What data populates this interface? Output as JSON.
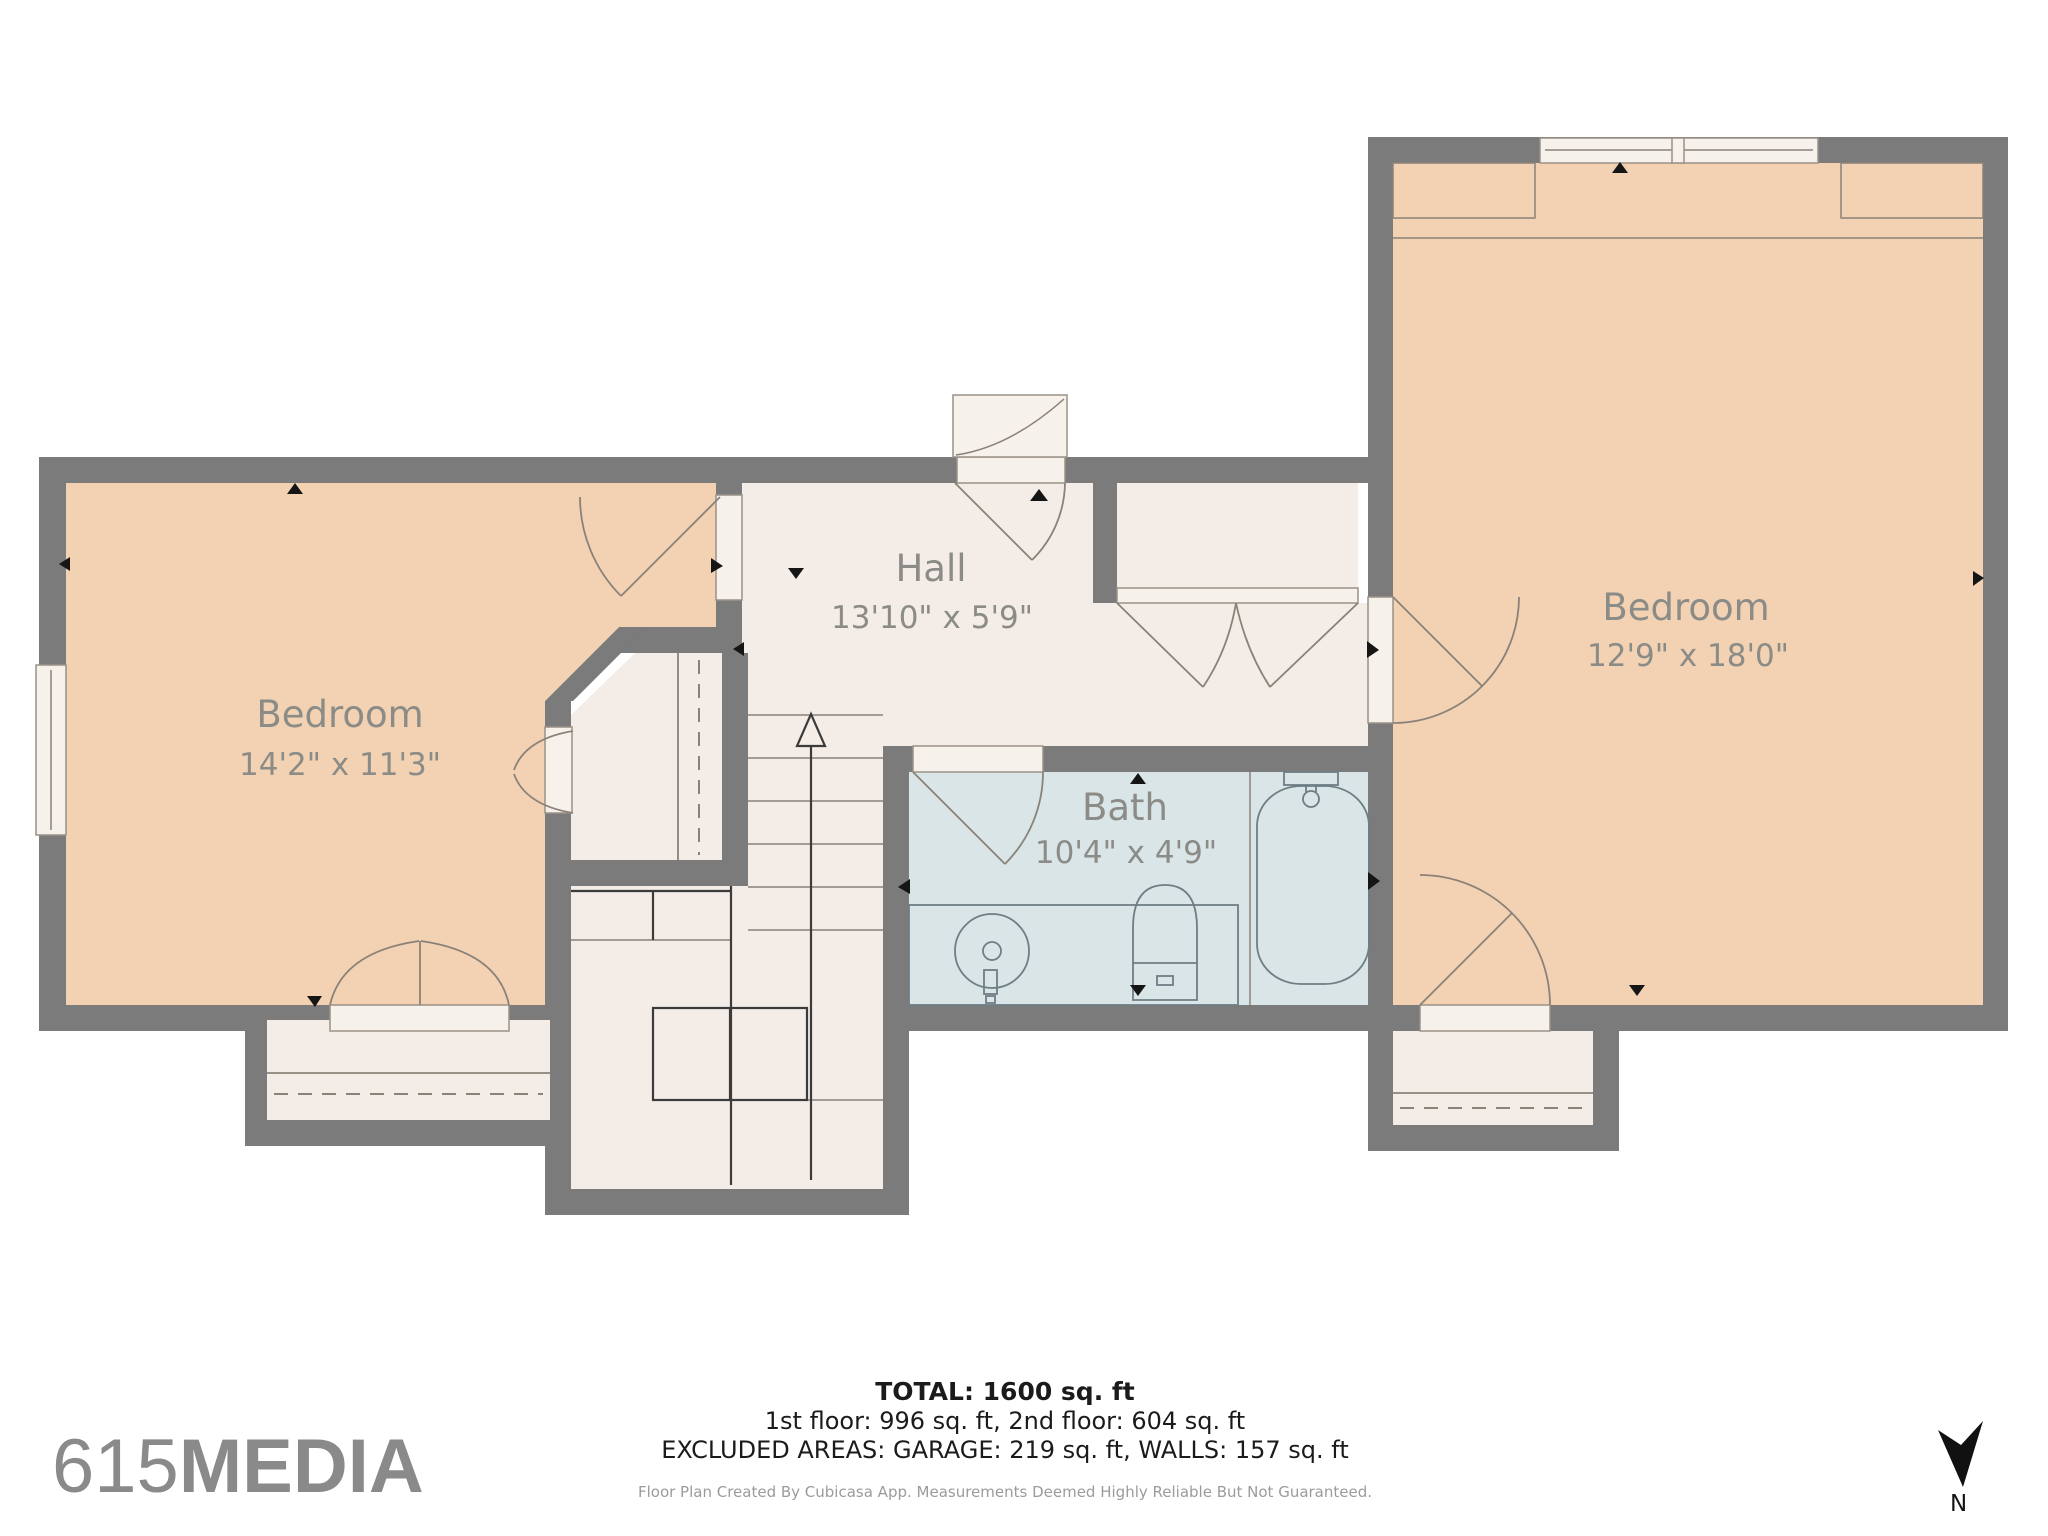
{
  "rooms": [
    {
      "name": "Hall",
      "dims": "13'10\" x 5'9\""
    },
    {
      "name": "Bedroom",
      "dims": "14'2\" x 11'3\""
    },
    {
      "name": "Bedroom",
      "dims": "12'9\" x 18'0\""
    },
    {
      "name": "Bath",
      "dims": "10'4\" x 4'9\""
    }
  ],
  "summary": {
    "total": "TOTAL: 1600 sq. ft",
    "floors": "1st floor: 996 sq. ft, 2nd floor: 604 sq. ft",
    "excluded": "EXCLUDED AREAS: GARAGE: 219 sq. ft, WALLS: 157 sq. ft",
    "disclaimer": "Floor Plan Created By Cubicasa App. Measurements Deemed Highly Reliable But Not Guaranteed."
  },
  "branding": {
    "logo_prefix": "615",
    "logo_suffix": "MEDIA"
  },
  "compass": {
    "label": "N"
  },
  "colors": {
    "wall": "#7b7b7b",
    "bedroom_fill": "#f2d2b2",
    "hall_fill": "#f4ede7",
    "bath_fill": "#d9e5e6",
    "label_text": "#8b8b87",
    "summary_text": "#1b1b1b",
    "logo_gray": "#8a8a8a"
  }
}
